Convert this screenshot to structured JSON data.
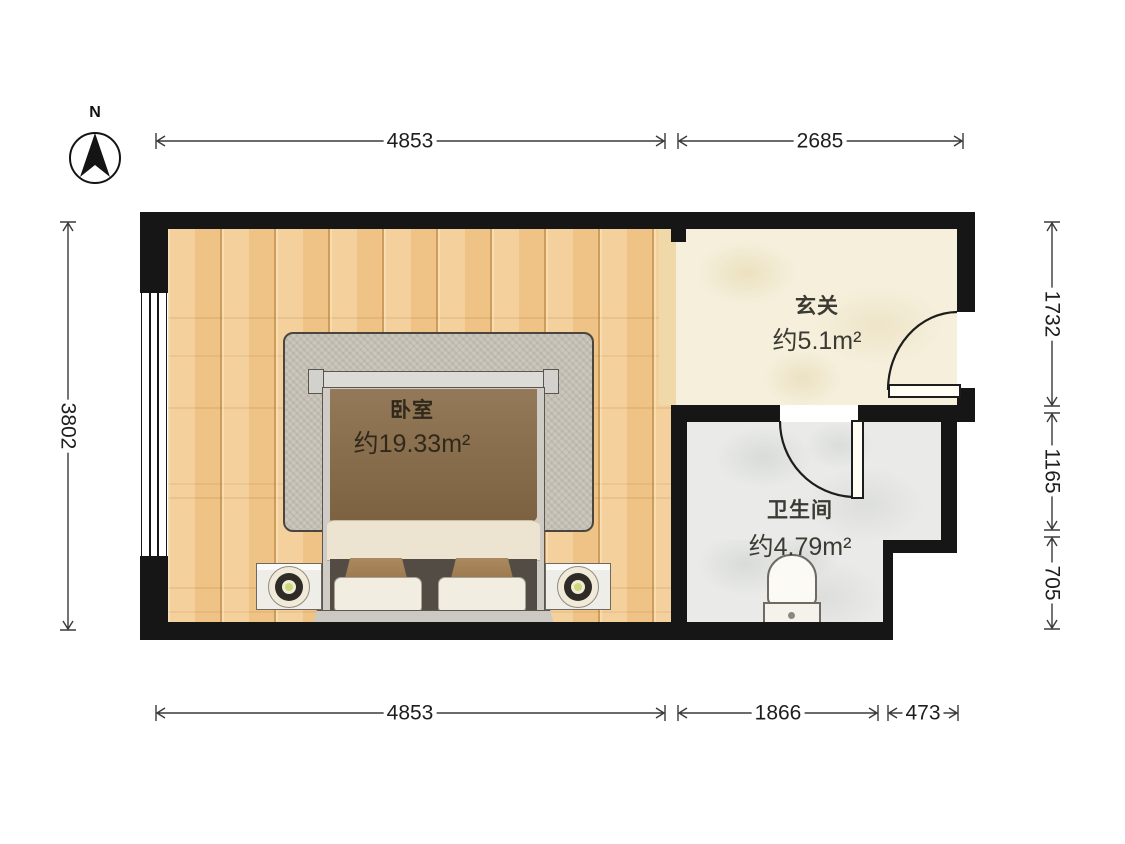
{
  "compass": {
    "label": "N"
  },
  "rooms": {
    "bedroom": {
      "name": "卧室",
      "area": "约19.33m²"
    },
    "entry": {
      "name": "玄关",
      "area": "约5.1m²"
    },
    "bathroom": {
      "name": "卫生间",
      "area": "约4.79m²"
    }
  },
  "dimensions": {
    "top": [
      {
        "label": "4853"
      },
      {
        "label": "2685"
      }
    ],
    "bottom": [
      {
        "label": "4853"
      },
      {
        "label": "1866"
      },
      {
        "label": "473"
      }
    ],
    "left": [
      {
        "label": "3802"
      }
    ],
    "right": [
      {
        "label": "1732"
      },
      {
        "label": "1165"
      },
      {
        "label": "705"
      }
    ]
  },
  "colors": {
    "wall": "#161616",
    "wood_floor": "#f3ca90",
    "entry_floor": "#f5efdb",
    "bath_floor": "#eaebe9",
    "carpet": "#ccc7bc",
    "duvet": "#876a46",
    "dimension_ink": "#3a3a3a"
  }
}
